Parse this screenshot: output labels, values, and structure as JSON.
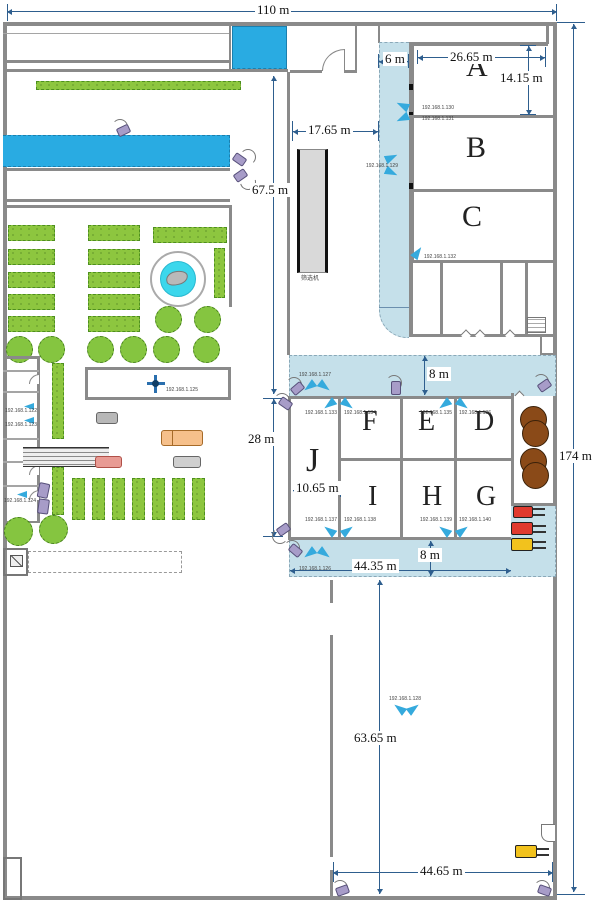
{
  "title": "factory-site-floor-plan",
  "colors": {
    "wall": "#8a8a8a",
    "dimension": "#2e5e8e",
    "pool_cyan": "#29abe2",
    "corridor_blue": "#c5e0ea",
    "hedge_green": "#8dc63f",
    "tank_brown": "#8a4a18",
    "forklift_red": "#e03a2f",
    "forklift_yellow": "#f2c21d",
    "ptz_purple": "#a79cc8",
    "camera_blue": "#35aadd"
  },
  "dims": {
    "d110": "110 m",
    "d174": "174 m",
    "d67": "67.5 m",
    "d17": "17.65 m",
    "d6": "6 m",
    "d26": "26.65 m",
    "d14": "14.15 m",
    "d28": "28 m",
    "d8a": "8 m",
    "d8b": "8 m",
    "d44_35": "44.35 m",
    "d10": "10.65 m",
    "d63": "63.65 m",
    "d44_65": "44.65 m"
  },
  "rooms": {
    "a": "A",
    "b": "B",
    "c": "C",
    "d": "D",
    "e": "E",
    "f": "F",
    "g": "G",
    "h": "H",
    "i": "I",
    "j": "J"
  },
  "machine": {
    "label": "筛选机"
  },
  "cameras": {
    "c122": "192.168.1.122",
    "c123": "192.168.1.123",
    "c124": "192.168.1.124",
    "c125": "192.168.1.125",
    "c126": "192.168.1.126",
    "c127": "192.168.1.127",
    "c128": "192.168.1.128",
    "c129": "192.168.1.129",
    "c130": "192.168.1.130",
    "c131": "192.168.1.131",
    "c132": "192.168.1.132",
    "c133": "192.168.1.133",
    "c134": "192.168.1.134",
    "c135": "192.168.1.135",
    "c136": "192.168.1.136",
    "c137": "192.168.1.137",
    "c138": "192.168.1.138",
    "c139": "192.168.1.139",
    "c140": "192.168.1.140"
  }
}
